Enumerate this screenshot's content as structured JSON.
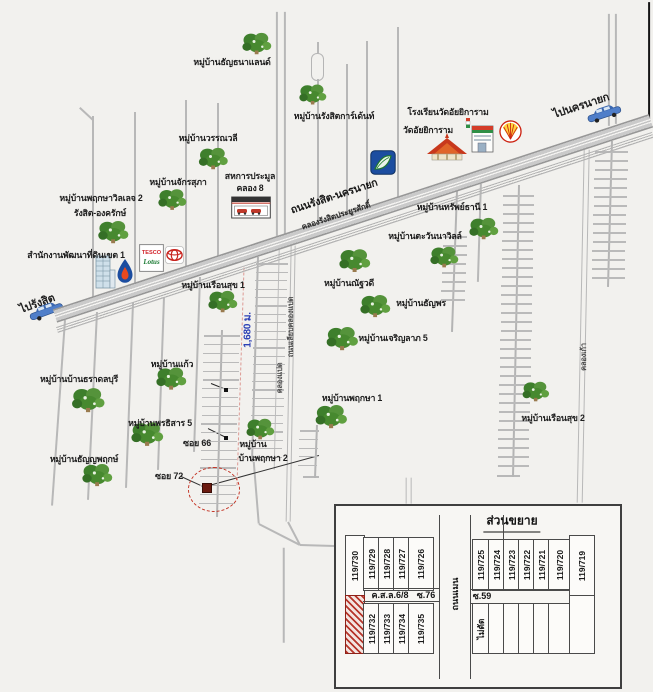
{
  "road_labels": {
    "main_road": "ถนนรังสิต-นครนายก",
    "canal": "คลองรังสิตประยูรศักดิ์",
    "to_nakhon_nayok": "ไปนครนายก",
    "to_rangsit": "ไปรังสิต",
    "khlong_kao": "คลองเก้า",
    "khlong_paed": "คลองแปด",
    "liab_khlong_paed": "ถนนเลียบคลองแปด",
    "soi_66": "ซอย 66",
    "soi_72": "ซอย 72",
    "distance": "1,680 ม."
  },
  "places": [
    {
      "id": "thanthana-land",
      "label": "หมู่บ้านธัญธนาแลนด์"
    },
    {
      "id": "wannawalee",
      "label": "หมู่บ้านวรรณวลี"
    },
    {
      "id": "jakrasupha",
      "label": "หมู่บ้านจักรสุภา"
    },
    {
      "id": "rangsit-garden",
      "label": "หมู่บ้านรังสิตการ์เด้นท์"
    },
    {
      "id": "pruksa-village-2",
      "label": "หมู่บ้านพฤกษาวิลเลจ 2"
    },
    {
      "id": "rangsit-ongkharak",
      "label": "รังสิต-องครักษ์"
    },
    {
      "id": "land-dev-office",
      "label": "สำนักงานพัฒนาที่ดินเขต 1"
    },
    {
      "id": "school-wat-aiyikaram",
      "label": "โรงเรียนวัดอัยยิการาม"
    },
    {
      "id": "wat-aiyikaram",
      "label": "วัดอัยยิการาม"
    },
    {
      "id": "sahakan-pramool",
      "label": "สหการประมูล"
    },
    {
      "id": "khlong-8",
      "label": "คลอง 8"
    },
    {
      "id": "sapthani-1",
      "label": "หมู่บ้านทรัพย์ธานี 1"
    },
    {
      "id": "tawanna-ville",
      "label": "หมู่บ้านตะวันนาวิลล์"
    },
    {
      "id": "natthawadee",
      "label": "หมู่บ้านณัฐวดี"
    },
    {
      "id": "thanyaporn",
      "label": "หมู่บ้านธัญพร"
    },
    {
      "id": "charoenlap-5",
      "label": "หมู่บ้านเจริญลาภ 5"
    },
    {
      "id": "ruensuk-1",
      "label": "หมู่บ้านเรือนสุข 1"
    },
    {
      "id": "pruksa-1",
      "label": "หมู่บ้านพฤกษา 1"
    },
    {
      "id": "ruensuk-2",
      "label": "หมู่บ้านเรือนสุข 2"
    },
    {
      "id": "kaew",
      "label": "หมู่บ้านแก้ว"
    },
    {
      "id": "tharadol-buri",
      "label": "หมู่บ้านบ้านธราดลบุรี"
    },
    {
      "id": "pornthisan-5",
      "label": "หมู่บ้านพรธิสาร 5"
    },
    {
      "id": "thanyapruek",
      "label": "หมู่บ้านธัญญพฤกษ์"
    },
    {
      "id": "mooban",
      "label": "หมู่บ้าน"
    },
    {
      "id": "baan-pruksa-2",
      "label": "บ้านพฤกษา 2"
    }
  ],
  "brand_text": {
    "tesco": "TESCO",
    "lotus": "Lotus"
  },
  "inset": {
    "title": "ส่วนขยาย",
    "left_top_plots": [
      "119/730",
      "119/729",
      "119/728",
      "119/727",
      "119/726"
    ],
    "left_bottom_plots": [
      "119/732",
      "119/733",
      "119/734",
      "119/735"
    ],
    "right_top_plots": [
      "119/725",
      "119/724",
      "119/723",
      "119/722",
      "119/721",
      "119/720",
      "119/719"
    ],
    "left_road_label": "ค.ส.ล.6/8",
    "left_soi_label": "ซ.76",
    "right_soi_label": "ซ.59",
    "main_road_label": "ถนนเมน",
    "uncut_label": "ไม่ตัด"
  },
  "colors": {
    "highlight_plot": "#b6352a",
    "marker_circle": "#c43425",
    "distance_text": "#2b3fb5",
    "road_gray": "#b8b8b8",
    "tree_green": "#4a8d35"
  }
}
